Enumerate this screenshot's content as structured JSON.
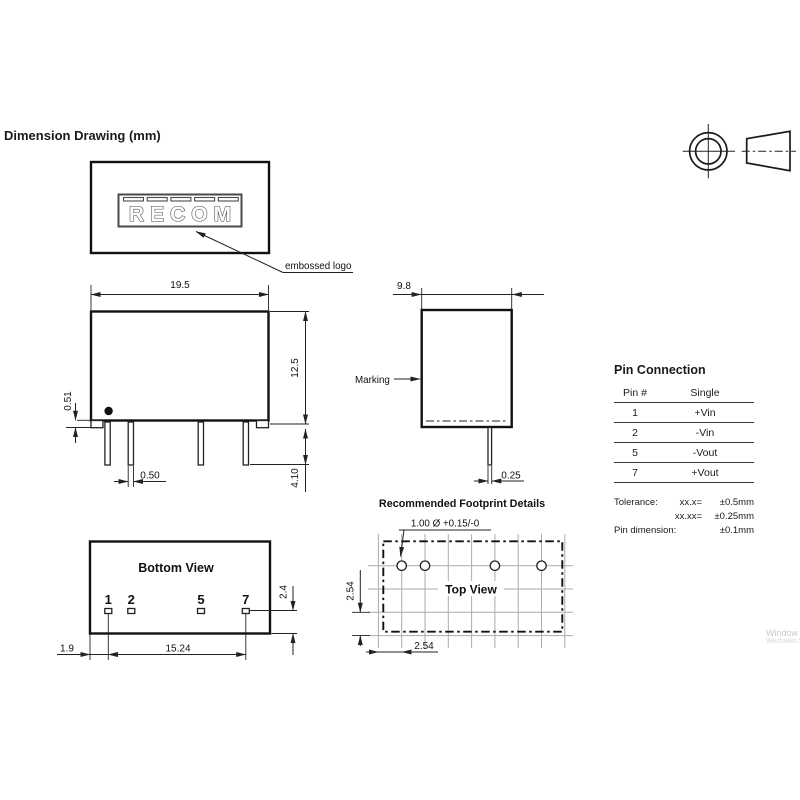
{
  "header": {
    "title": "Dimension Drawing (mm)"
  },
  "logo_panel": {
    "logo_text": "RECOM",
    "callout": "embossed logo"
  },
  "front_view": {
    "width": "19.5",
    "height": "12.5",
    "standoff": "0.51",
    "pin_width": "0.50",
    "pin_length": "4.10"
  },
  "side_view": {
    "depth": "9.8",
    "pin_thickness": "0.25",
    "marking_label": "Marking"
  },
  "bottom_view": {
    "title": "Bottom View",
    "pin_labels": [
      "1",
      "2",
      "5",
      "7"
    ],
    "pad_height": "2.4",
    "edge_to_pin1": "1.9",
    "pin_span": "15.24"
  },
  "footprint": {
    "title": "Recommended Footprint Details",
    "view_label": "Top View",
    "hole_label": "1.00 Ø +0.15/-0",
    "vertical_pitch": "2.54",
    "horizontal_pitch": "2.54"
  },
  "pin_table": {
    "title": "Pin Connection",
    "headers": [
      "Pin #",
      "Single"
    ],
    "rows": [
      {
        "pin": "1",
        "single": "+Vin"
      },
      {
        "pin": "2",
        "single": "-Vin"
      },
      {
        "pin": "5",
        "single": "-Vout"
      },
      {
        "pin": "7",
        "single": "+Vout"
      }
    ],
    "tolerance": {
      "label": "Tolerance:",
      "row1_key": "xx.x=",
      "row1_val": "±0.5mm",
      "row2_key": "xx.xx=",
      "row2_val": "±0.25mm",
      "pin_dim_label": "Pin dimension:",
      "pin_dim_val": "±0.1mm"
    }
  },
  "watermark": {
    "line1": "Window",
    "line2": "Wechseln S"
  }
}
